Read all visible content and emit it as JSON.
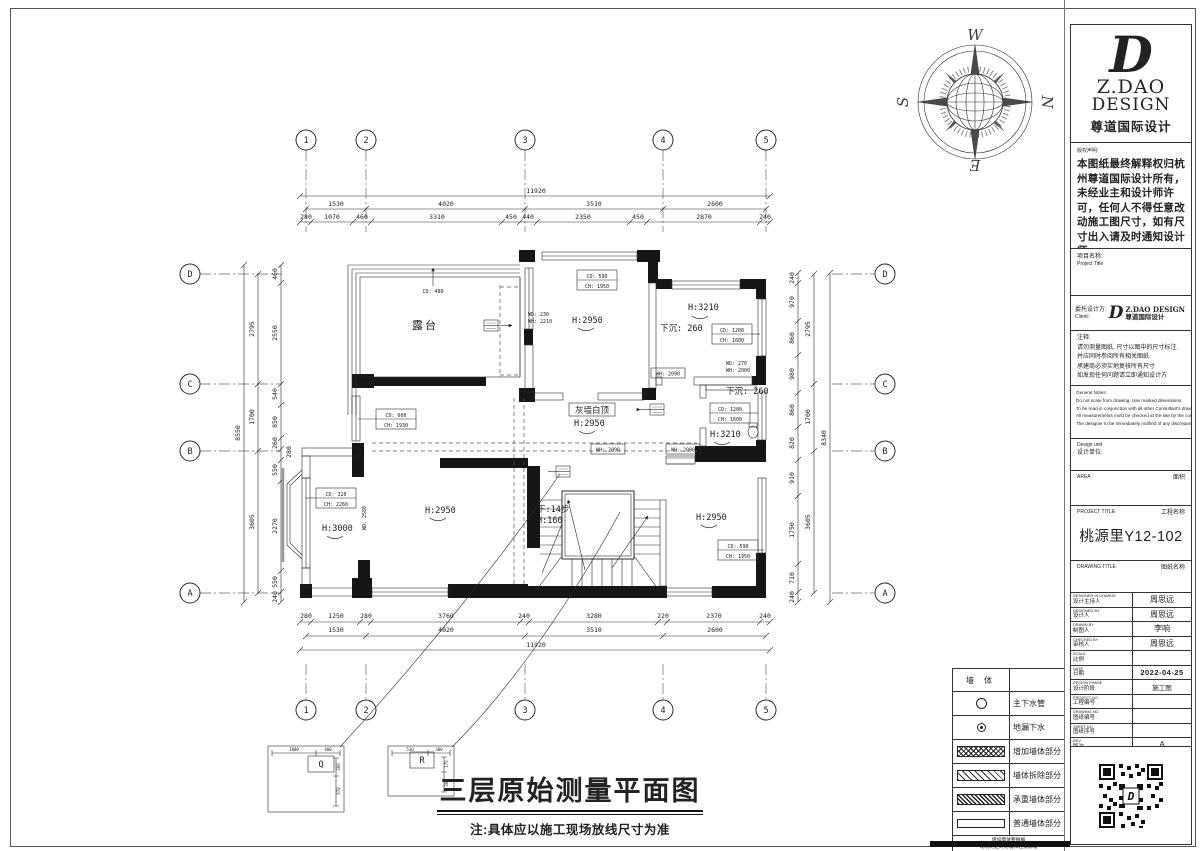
{
  "compass": {
    "n": "N",
    "s": "S",
    "e": "E",
    "w": "W"
  },
  "title": {
    "main": "三层原始测量平面图",
    "note": "注:具体应以施工现场放线尺寸为准"
  },
  "titleblock": {
    "logo": {
      "d": "D",
      "line1": "Z.DAO",
      "line2": "DESIGN",
      "line3": "尊道国际设计"
    },
    "copyright_label": "版权声明:",
    "copyright_text": "本图纸最终解释权归杭州尊道国际设计所有，未经业主和设计师许可，任何人不得任意改动施工图尺寸，如有尺寸出入请及时通知设计师。",
    "project_name_label": "项目名称:",
    "project_name_label_en": "Project Title",
    "client_label": "委托设计方:",
    "client_label_en": "Client:",
    "client_logo_d": "D",
    "client_logo_line1": "Z.DAO DESIGN",
    "client_logo_line2": "尊道国际设计",
    "notes_label": "注释:",
    "notes": [
      "请勿测量图纸, 尺寸以图中的尺寸标注.",
      "并应同时参阅所有相关图纸.",
      "承建商必须实地复核所有尺寸",
      "如发现任何问题请立即通知设计方"
    ],
    "general_notes_label": "General Notes:",
    "general_notes": [
      "Do not scale from drawing. Use marked dimensions.",
      "To be read in conjunction with all other Consultant's drawings.",
      "All measurements must be checked at the site by the contractor",
      "The designer to be immediately notified of any discrepancies."
    ],
    "design_unit_en": "Design unit",
    "design_unit_cn": "设计单位:",
    "area_en": "AREA",
    "area_cn": "面积",
    "project_title_en": "PROJECT TITLE",
    "project_title_cn": "工程名称",
    "project_title_value": "桃源里Y12-102",
    "drawing_title_en": "DRAWING TITLE",
    "drawing_title_cn": "图纸名称",
    "table": [
      {
        "en": "DESIGNER IN CHARGE",
        "cn": "设计主持人",
        "value": "周思远"
      },
      {
        "en": "DESIGNED BY",
        "cn": "设计人",
        "value": "周思远"
      },
      {
        "en": "DRAWN BY",
        "cn": "制图人",
        "value": "李响"
      },
      {
        "en": "CHECKED BY",
        "cn": "审核人",
        "value": "周思远"
      },
      {
        "en": "SCALE",
        "cn": "比例",
        "value": ""
      },
      {
        "en": "DATE",
        "cn": "日期",
        "value": "2022-04-25"
      },
      {
        "en": "DESIGN PHASE",
        "cn": "设计阶段",
        "value": "施工图"
      },
      {
        "en": "PROJECT NO",
        "cn": "工程编号",
        "value": ""
      },
      {
        "en": "DRAWING NO",
        "cn": "图纸编号",
        "value": ""
      },
      {
        "en": "SHEET NO",
        "cn": "图纸序号",
        "value": ""
      },
      {
        "en": "REV",
        "cn": "版次",
        "value": "A"
      }
    ]
  },
  "legend": {
    "header": "墙 体",
    "items": [
      {
        "label": "主下水管"
      },
      {
        "label": "地漏下水"
      },
      {
        "label": "增加墙体部分"
      },
      {
        "label": "墙体拆除部分"
      },
      {
        "label": "承重墙体部分"
      },
      {
        "label": "普通墙体部分"
      }
    ],
    "footer1": "增加墙体要根据",
    "footer2": "现场制定砖砌墙和轻钢隔墙"
  },
  "plan": {
    "grid_cols": [
      "1",
      "2",
      "3",
      "4",
      "5"
    ],
    "grid_rows": [
      "A",
      "B",
      "C",
      "D"
    ],
    "dims": {
      "top_total": "11920",
      "top_major": [
        "1530",
        "4020",
        "3510",
        "2600"
      ],
      "top_fine": [
        "280",
        "1070",
        "460",
        "3310",
        "450",
        "440",
        "2350",
        "450",
        "2870",
        "240"
      ],
      "bottom_fine": [
        "280",
        "1250",
        "280",
        "3760",
        "240",
        "3280",
        "220",
        "2370",
        "240"
      ],
      "bottom_major": [
        "1530",
        "4020",
        "3510",
        "2600"
      ],
      "bottom_total": "11920",
      "left_total": "8550",
      "left_major": [
        "3605",
        "1700",
        "2795"
      ],
      "left_fine": [
        "240",
        "550",
        "2270",
        "550",
        "280",
        "260",
        "850",
        "540",
        "2550",
        "460"
      ],
      "right_fine": [
        "240",
        "710",
        "1750",
        "910",
        "820",
        "860",
        "980",
        "860",
        "970",
        "240"
      ],
      "right_major": [
        "3605",
        "1700",
        "2795"
      ],
      "right_total": "8340"
    },
    "rooms": {
      "terrace": "露台",
      "center_h": "H:2950",
      "topright_h": "H:3210",
      "topright_sunken": "下沉: 260",
      "bath_sunken": "下沉: 260",
      "bath_h": "H:3210",
      "hall_finish": "灰墙白顶",
      "hall_h": "H:2950",
      "bl_h": "H:3000",
      "bc_h": "H:2950",
      "br_h": "H:2950",
      "stair_steps": "下:14步",
      "stair_h": "H:160"
    },
    "annotations": {
      "cd480": "CD: 480",
      "box_cd590": [
        "CD: 590",
        "CH: 1950"
      ],
      "box_cd1200a": [
        "CD: 1200",
        "CH: 1600"
      ],
      "box_cd1200b": [
        "CD: 1200",
        "CH: 1600"
      ],
      "box_cd600": [
        "CD: 600",
        "CH: 1930"
      ],
      "box_cd320": [
        "CD: 320",
        "CH: 2260"
      ],
      "box_cd592": [
        "CD: 590",
        "CH: 1950"
      ],
      "wd230": [
        "WD: 230",
        "WH: 2210"
      ],
      "wd270": [
        "WD: 270",
        "WH: 2000"
      ],
      "wh2090": "WH: 2090",
      "wd2580": "WD: 2580"
    },
    "details": {
      "q_label": "Q",
      "r_label": "R",
      "q_dims": [
        "1000",
        "400",
        "200",
        "570"
      ],
      "r_dims": [
        "530",
        "300",
        "170",
        "300"
      ]
    }
  }
}
